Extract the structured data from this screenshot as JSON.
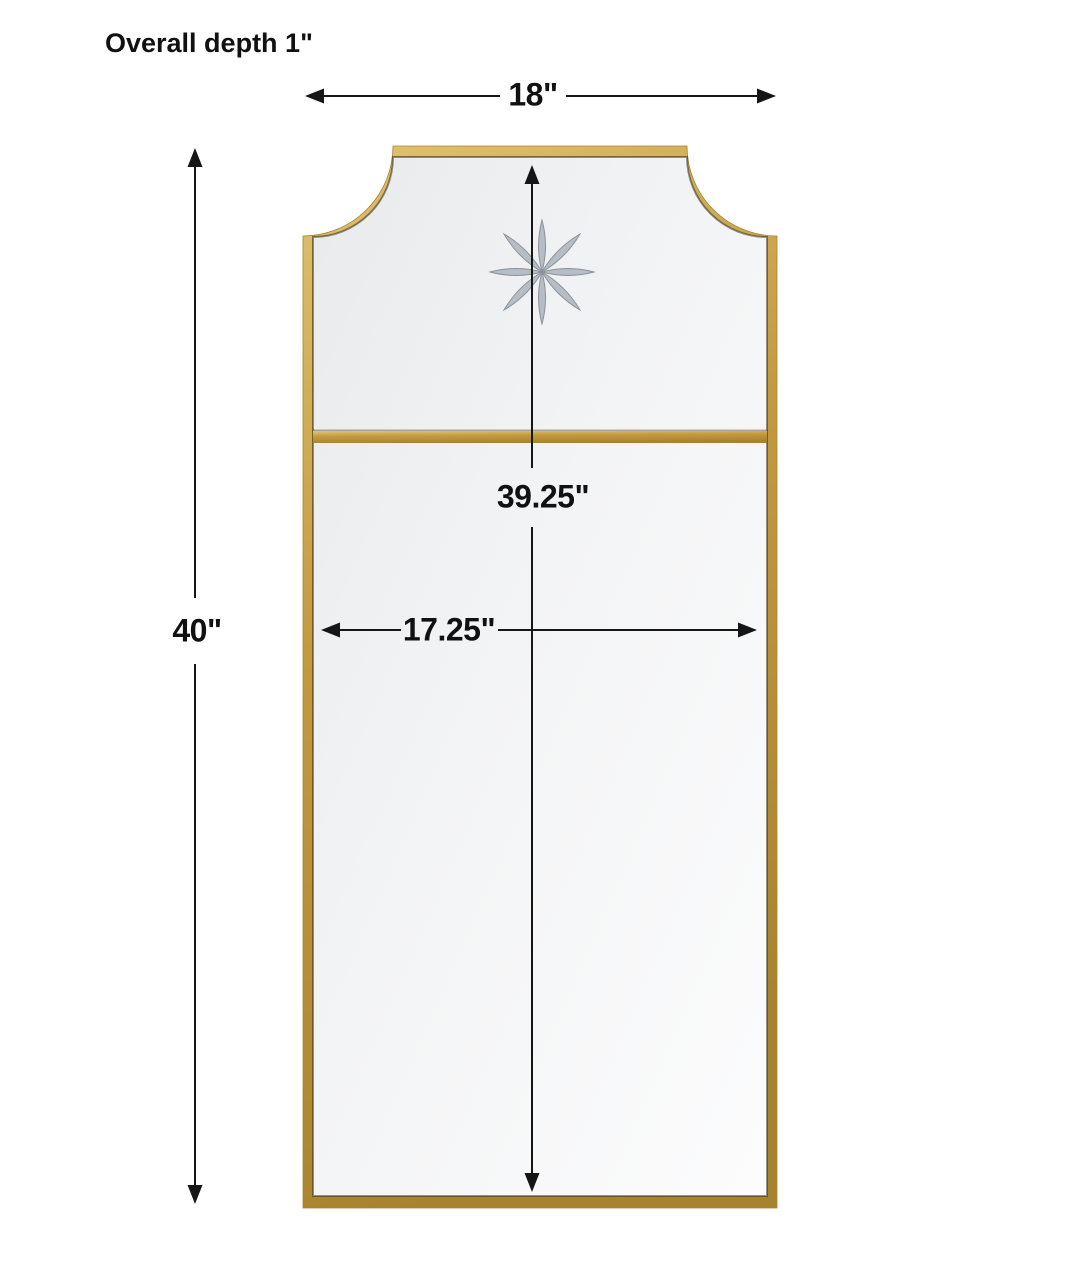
{
  "figure": {
    "subject": "full-length wall mirror with gold frame, scalloped top corners, horizontal divider bar and etched star accent"
  },
  "labels": {
    "overall_depth": "Overall depth 1\""
  },
  "dimensions": {
    "overall_width": "18\"",
    "overall_height": "40\"",
    "mirror_height": "39.25\"",
    "mirror_width": "17.25\""
  },
  "colors": {
    "line": "#161616",
    "text": "#111111",
    "background": "#ffffff",
    "frame_gold": "#c39a40",
    "frame_gold_light": "#e2c272",
    "frame_gold_dark": "#a8832f",
    "mirror_light": "#fcfcfd",
    "mirror_mid": "#f3f4f5",
    "mirror_shade": "#e8eaec",
    "star_fill": "#b7bdc4",
    "star_edge": "#8b929b"
  }
}
